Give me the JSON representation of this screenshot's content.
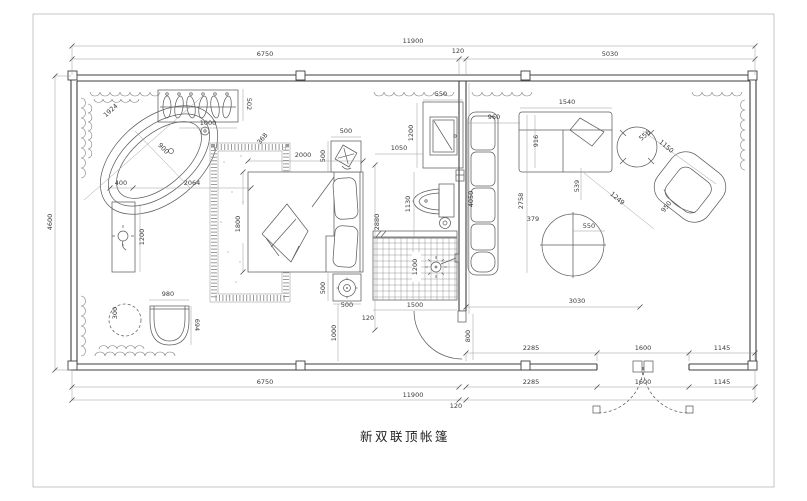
{
  "title": "新双联顶帐篷",
  "colors": {
    "wall_line": "#3f3f3f",
    "furniture_line": "#5f5f5f",
    "dimension_line": "#9a9a9a",
    "text": "#3a3a3a",
    "background": "#ffffff"
  },
  "dims": {
    "top_overall": "11900",
    "top_left": "6750",
    "top_partition": "120",
    "top_right": "5030",
    "side_left": "4600",
    "tub_length": "1924",
    "tub_width": "900",
    "rack_width": "1000",
    "rack_depth": "502",
    "rack_offset": "368",
    "console_width": "400",
    "console_gap": "2064",
    "console_length": "1200",
    "stool_dia": "300",
    "chair_width": "980",
    "chair_depth": "694",
    "bed_length": "2000",
    "bed_width": "1800",
    "ns_top_w": "500",
    "ns_top_h": "500",
    "ns_bot_w": "500",
    "ns_bot_h": "500",
    "bed_to_wall": "2880",
    "tv_gap": "1050",
    "tv_width": "550",
    "tv_height": "1200",
    "toilet_len": "1130",
    "partition_len": "4050",
    "shower_h": "1200",
    "shower_w": "1500",
    "door_open": "800",
    "rug_gap": "120",
    "rug_offset": "1000",
    "sofa_gap": "960",
    "sofa_depth": "916",
    "sofa_width": "1540",
    "bench_len": "2758",
    "bench_gap": "379",
    "side_table": "556",
    "chair_diag1": "1150",
    "chair_diag2": "950",
    "chair_dist": "1249",
    "round_table": "550",
    "table_gap": "539",
    "living_width": "3030",
    "bot_in_1": "2285",
    "bot_in_2": "1600",
    "bot_in_3": "1145",
    "bot_out_1": "2285",
    "bot_out_2": "1600",
    "bot_out_3": "1145",
    "bottom_left": "6750",
    "bottom_overall": "11900",
    "bottom_partition": "120"
  }
}
